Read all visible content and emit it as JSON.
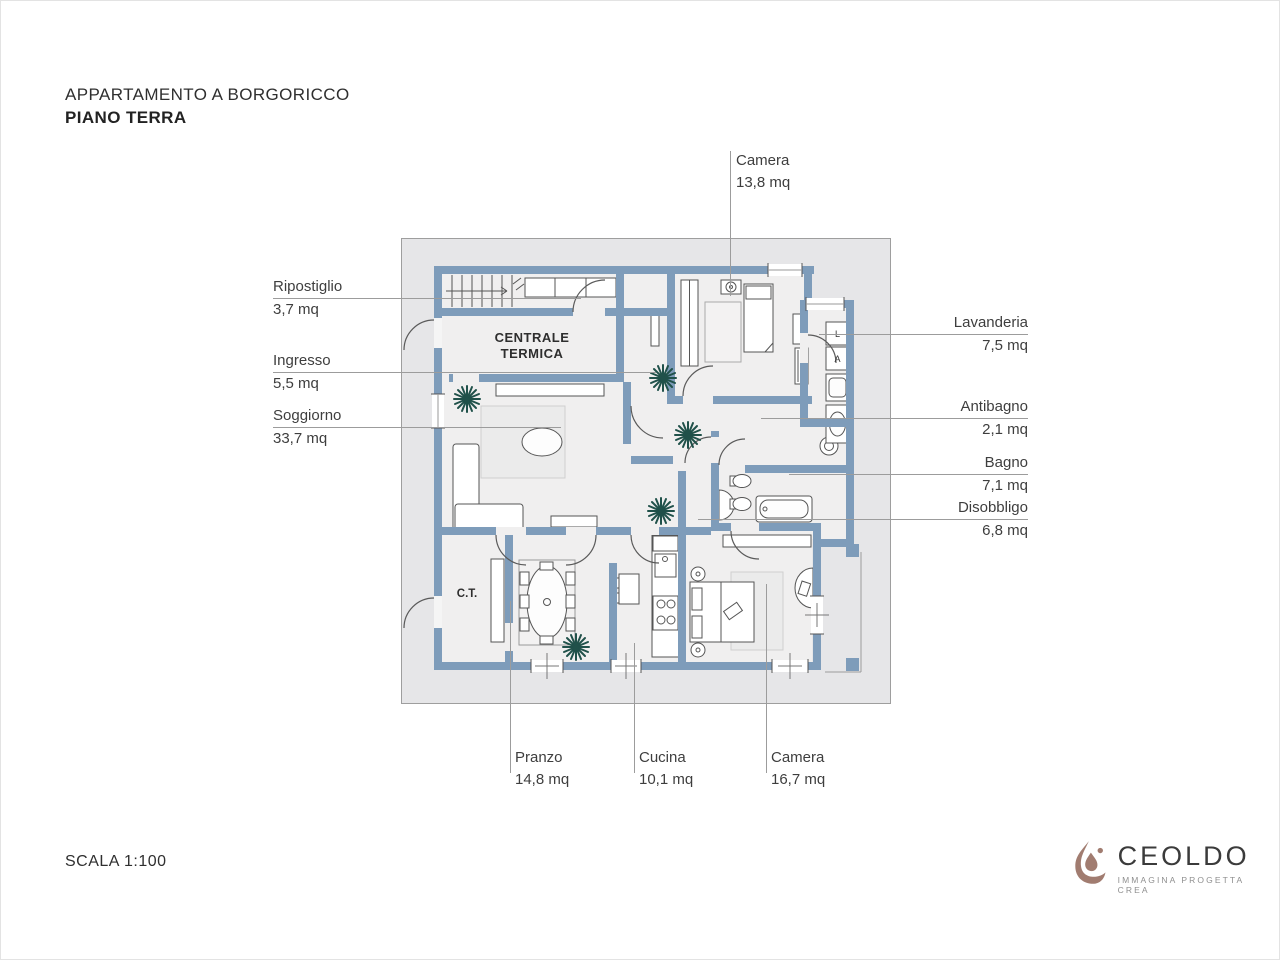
{
  "title": {
    "line1": "APPARTAMENTO A BORGORICCO",
    "line2": "PIANO TERRA"
  },
  "footer": {
    "scale": "SCALA 1:100"
  },
  "logo": {
    "brand": "CEOLDO",
    "tagline": "IMMAGINA PROGETTA CREA"
  },
  "plan": {
    "inner_labels": {
      "centrale_termica_line1": "CENTRALE",
      "centrale_termica_line2": "TERMICA",
      "ct": "C.T.",
      "washer": "L",
      "dryer": "A"
    },
    "rooms": {
      "camera_top": {
        "name": "Camera",
        "area": "13,8 mq"
      },
      "ripostiglio": {
        "name": "Ripostiglio",
        "area": "3,7 mq"
      },
      "ingresso": {
        "name": "Ingresso",
        "area": "5,5 mq"
      },
      "soggiorno": {
        "name": "Soggiorno",
        "area": "33,7 mq"
      },
      "lavanderia": {
        "name": "Lavanderia",
        "area": "7,5 mq"
      },
      "antibagno": {
        "name": "Antibagno",
        "area": "2,1 mq"
      },
      "bagno": {
        "name": "Bagno",
        "area": "7,1 mq"
      },
      "disobbligo": {
        "name": "Disobbligo",
        "area": "6,8 mq"
      },
      "pranzo": {
        "name": "Pranzo",
        "area": "14,8 mq"
      },
      "cucina": {
        "name": "Cucina",
        "area": "10,1 mq"
      },
      "camera_bottom": {
        "name": "Camera",
        "area": "16,7 mq"
      }
    }
  },
  "colors": {
    "wall": "#7e9cba",
    "plan_backdrop": "#e6e6e8",
    "floor": "#f0efef",
    "leader_line": "#9c9c9c",
    "plant_green": "#20514a",
    "logo_brown": "#a17c70",
    "text": "#3e3e3e"
  }
}
